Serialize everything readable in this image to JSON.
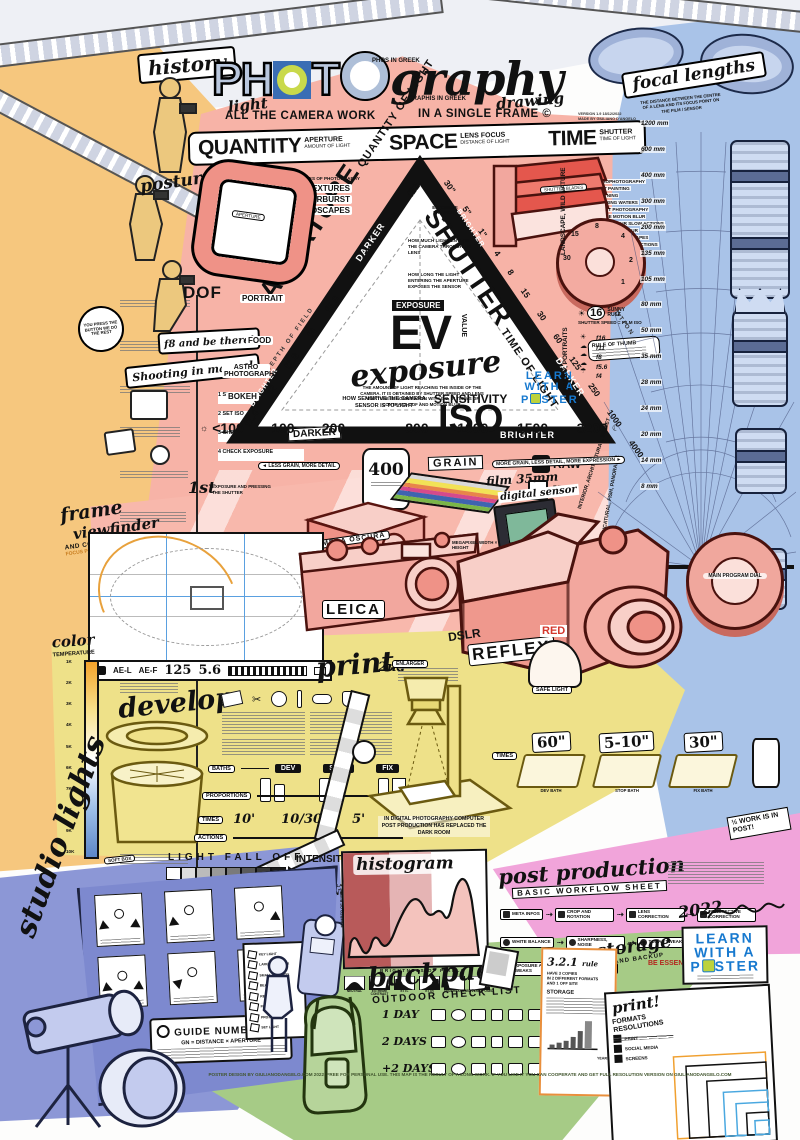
{
  "colors": {
    "orange": "#f6c77e",
    "pink": "#f7b3a7",
    "blue": "#a9c3e8",
    "yellow": "#eee189",
    "periwinkle": "#8c97d6",
    "magenta": "#f1a4da",
    "green": "#a6cb86",
    "lwp_blue": "#1779cf"
  },
  "header": {
    "t1": "PH",
    "t2": "O",
    "t3": "T",
    "t4": "O",
    "t5": "graphy",
    "light": "light",
    "phos": "PHOS IN GREEK",
    "graphis": "GRAPHIS IN GREEK",
    "drawing": "drawing",
    "sub1": "ALL THE CAMERA WORK",
    "sub2": "IN A SINGLE FRAME ©",
    "version": "VERSION 1.9  18/12/2022",
    "made_by": "MADE BY GIULIANO D'ANGELO"
  },
  "banner": {
    "items": [
      {
        "word": "QUANTITY",
        "s1": "APERTURE",
        "s2": "AMOUNT OF LIGHT"
      },
      {
        "word": "SPACE",
        "s1": "LENS FOCUS",
        "s2": "DISTANCE OF LIGHT"
      },
      {
        "word": "TIME",
        "s1": "SHUTTER",
        "s2": "TIME OF LIGHT"
      }
    ]
  },
  "left": {
    "history": "history",
    "posture": "posture",
    "dof": "DOF",
    "kodak": "YOU PRESS THE BUTTON WE DO THE REST",
    "f8": "f8 and be there!",
    "manual_title": "Shooting in manual",
    "manual_steps": [
      "1  SET APERTURE",
      "2  SET ISO",
      "3  CHECK SHUTTER SPEED",
      "4  CHECK EXPOSURE"
    ]
  },
  "triangle": {
    "aperture": "APERTURE",
    "aperture_sub": "QUANTITY OF LIGHT",
    "shutter": "SHUTTER",
    "shutter_sub": "TIME OF LIGHT",
    "iso": "ISO",
    "iso_sub": "SENSITIVITY",
    "exposure_label": "EXPOSURE",
    "ev": "EV",
    "value": "VALUE",
    "exposure_script": "exposure",
    "exposure_note": "THE AMOUNT OF LIGHT REACHING THE INSIDE OF THE CAMERA. IT IS OBTAINED BY SHUTTER SPEED AND LENS APERTURE IN COMBINATION WITH ISO, IN TERMS OF CONTRAST, DOF AND MOTION BLUR.",
    "triangle_label": "EXPOSURE TRIANGLE",
    "aperture_note": "HOW MUCH LIGHT ENTERS THE CAMERA THROUGH THE LENS",
    "shutter_note": "HOW LONG THE LIGHT ENTERING THE APERTURE EXPOSES THE SENSOR",
    "iso_note": "HOW SENSITIVE THE CAMERA SENSOR IS TO LIGHT",
    "darker": "DARKER",
    "brighter": "BRIGHTER",
    "depth": "DEPTH OF FIELD",
    "motion": "MOTION",
    "fstops": [
      "f1.4",
      "f2",
      "f2.8",
      "f4",
      "f5.6",
      "f8",
      "f11",
      "f16",
      "f22"
    ],
    "shutters": [
      "30\"",
      "5\"",
      "1\"",
      "4",
      "8",
      "15",
      "30",
      "60",
      "125",
      "250",
      "1000",
      "4000"
    ],
    "isos_left": [
      "<100",
      "100",
      "200"
    ],
    "isos_right": [
      "800",
      "1000",
      "1500",
      "3200"
    ],
    "types_title": "TYPES OF PHOTOGRAPHY",
    "types": [
      "TEXTURES",
      "STARBURST",
      "LANDSCAPES"
    ],
    "macro": "MACRO",
    "portrait": "PORTRAIT",
    "food": "FOOD",
    "astro": "ASTRO PHOTOGRAPHY",
    "bokeh": "BOKEH",
    "uses": [
      "ASTROPHOTOGRAPHY",
      "LIGHT PAINTING",
      "LIGHTNING",
      "BLURRING WATERS",
      "STREET PHOTOGRAPHY",
      "PEOPLE MOTION BLUR",
      "FEELING BLUR SLOW ACTIONS",
      "RAIN MOTION BLUR",
      "GENERAL LANDSCAPES",
      "FREEZING HINT OF ACTIONS",
      "PORTRAITS",
      "MOTOR VEHICLES",
      "SPORT ACTIONS",
      "FLYING BIRDS",
      "HIGH SPEED VEHICLES",
      "VERY FAST ACTIONS"
    ],
    "shutter_blades": "SHUTTER BLADES",
    "rule_thumb": "RULE OF THUMB"
  },
  "sunny16": {
    "n": "16",
    "t1": "SUNNY",
    "t2": "RULE",
    "eq1": "SHUTTER",
    "eq2": "SPEED",
    "eq3": "FILM",
    "eq4": "ISO",
    "stops": [
      "f16",
      "f11",
      "f8",
      "f5.6",
      "f4"
    ]
  },
  "grain": {
    "less": "◄ LESS GRAIN, MORE DETAIL",
    "more": "MORE GRAIN, LESS DETAIL, MORE EXPRESSION ►",
    "grain": "GRAIN",
    "film": "film 35mm",
    "roll": "400"
  },
  "formats": {
    "raw": "RAW",
    "dng": "DNG",
    "jpg": "JPG"
  },
  "focal": {
    "title": "focal lengths",
    "desc": "THE DISTANCE BETWEEN THE CENTRE OF A LENS AND ITS FOCUS POINT ON THE FILM / SENSOR",
    "mm": [
      "1200 mm",
      "600 mm",
      "400 mm",
      "300 mm",
      "200 mm",
      "135 mm",
      "105 mm",
      "80 mm",
      "50 mm",
      "35 mm",
      "28 mm",
      "24 mm",
      "20 mm",
      "14 mm",
      "8 mm"
    ],
    "deg": "180°",
    "cat1": "LANDSCAPE, WILD NATURE",
    "cat2": "MACRO, PORTRAITS",
    "cat3": "INTERIOR, ARCHITECTURAL, STREET",
    "cat4": "CARICATURAL, FISH, PANORAMIC"
  },
  "cameras": {
    "first": "1st",
    "first_sub": "EXPOSURE AND PRESSING THE SHUTTER",
    "obscura": "CAMERA OSCURA",
    "frame": "frame",
    "viewfinder": "viewfinder",
    "comp": "AND COMPOSITION RULES",
    "focus": "FOCUS POINTS",
    "ael": "AE-L",
    "aef": "AE-F",
    "speed": "125",
    "fnum": "5.6",
    "leica": "LEICA",
    "dslr": "DSLR",
    "reflex": "REFLEX",
    "digital": "digital sensor",
    "megapixel": "MEGAPIXEL WIDTH × HEIGHT",
    "dial": "MAIN PROGRAM DIAL"
  },
  "colortemp": {
    "title": "color",
    "sub": "TEMPERATURE",
    "ticks": [
      "1K",
      "2K",
      "3K",
      "4K",
      "5K",
      "6K",
      "7K",
      "8K",
      "9K",
      "10K"
    ]
  },
  "develop": {
    "title": "develop",
    "baths_label": "BATHS",
    "prop_label": "PROPORTIONS",
    "times_label": "TIMES",
    "actions_label": "ACTIONS",
    "baths": [
      "DEV",
      "STOP",
      "FIX"
    ],
    "times": [
      "10'",
      "10/30'",
      "5'"
    ]
  },
  "printsec": {
    "title": "print",
    "second": "2nd",
    "enlarger": "ENLARGER",
    "red": "RED",
    "safe": "SAFE LIGHT",
    "times_label": "TIMES",
    "trays": [
      {
        "time": "60\"",
        "name": "DEV BATH"
      },
      {
        "time": "5-10\"",
        "name": "STOP BATH"
      },
      {
        "time": "30\"",
        "name": "FIX BATH"
      }
    ],
    "note": "IN DIGITAL PHOTOGRAPHY COMPUTER POST PRODUCTION HAS REPLACED THE DARK ROOM"
  },
  "postprod": {
    "title": "post production",
    "sub": "BASIC WORKFLOW SHEET",
    "half": "½ WORK IS IN POST!",
    "be": "BE ESSENTIAL!",
    "sig": "2022",
    "row1": [
      "META INFOS",
      "CROP AND ROTATION",
      "LENS CORRECTION",
      "PERSPECTIVE CORRECTION"
    ],
    "row2": [
      "WHITE BALANCE",
      "SHARPNESS, NOISE",
      "TONAL TWEAKS",
      "SHADOWS / HIGHLIGHTS"
    ],
    "row3": [
      "EXPOSURE AND CURVES TWEAKS",
      "BATCH"
    ]
  },
  "studio": {
    "title1": "studio",
    "title2": "lights",
    "softbox": "SOFT BOX",
    "falloff": "LIGHT FALL OFF",
    "intensity": "INTENSITY",
    "oflight": "OF LIGHT",
    "inverse": "INVERSE SQUARE LAW",
    "formula": "1/DISTANCE²",
    "guide": "GUIDE NUMBER",
    "guide_eq": "GN = DISTANCE × APERTURE",
    "legend": [
      "KEY LIGHT",
      "LARGE SOFT BOX",
      "SMALL SOFT BOX",
      "BEAUTY DISH",
      "REFLECTOR",
      "FLASH",
      "PROJECTOR",
      "SET LIGHT"
    ]
  },
  "histogram": {
    "title": "histogram",
    "ylabel": "NUMBER OF PIXELS",
    "xlabel": "BRIGHTNESS OF PIXELS",
    "thumbs": [
      "NEUTRAL",
      "EXTREME CONTRAST",
      "ETTL",
      "ETTR",
      "UNDEREXPOSED",
      "OVEREXPOSED"
    ]
  },
  "backpack": {
    "title": "backpack",
    "sub": "OUTDOOR CHECK LIST",
    "rows": [
      "1 DAY",
      "2 DAYS",
      "+2 DAYS"
    ]
  },
  "storage": {
    "title": "storage",
    "sub": "AND BACKUP",
    "rule_n": "3.2.1",
    "rule_w": "rule",
    "l1": "HAVE 3 COPIES",
    "l2": "IN 2 DIFFERENT FORMATS",
    "l3": "AND 1 OFF SITE",
    "label": "STORAGE",
    "years": "YEARS"
  },
  "printfmt": {
    "title": "print!",
    "sub": "FORMATS RESOLUTIONS",
    "legend": [
      "PRINT",
      "SOCIAL MEDIA",
      "SCREENS"
    ]
  },
  "lwp": {
    "l1": "LEARN",
    "l2": "WITH A",
    "p": "P",
    "ster": "STER"
  },
  "footer": "POSTER DESIGN BY GIULIANODANGELO.COM 2022. FREE FOR PERSONAL USE. THIS MAP IS THE RESULT OF A LONG WORK. IF YOU LIKE IT YOU CAN COOPERATE AND GET FULL RESOLUTION VERSION ON GIULIANODANGELO.COM"
}
